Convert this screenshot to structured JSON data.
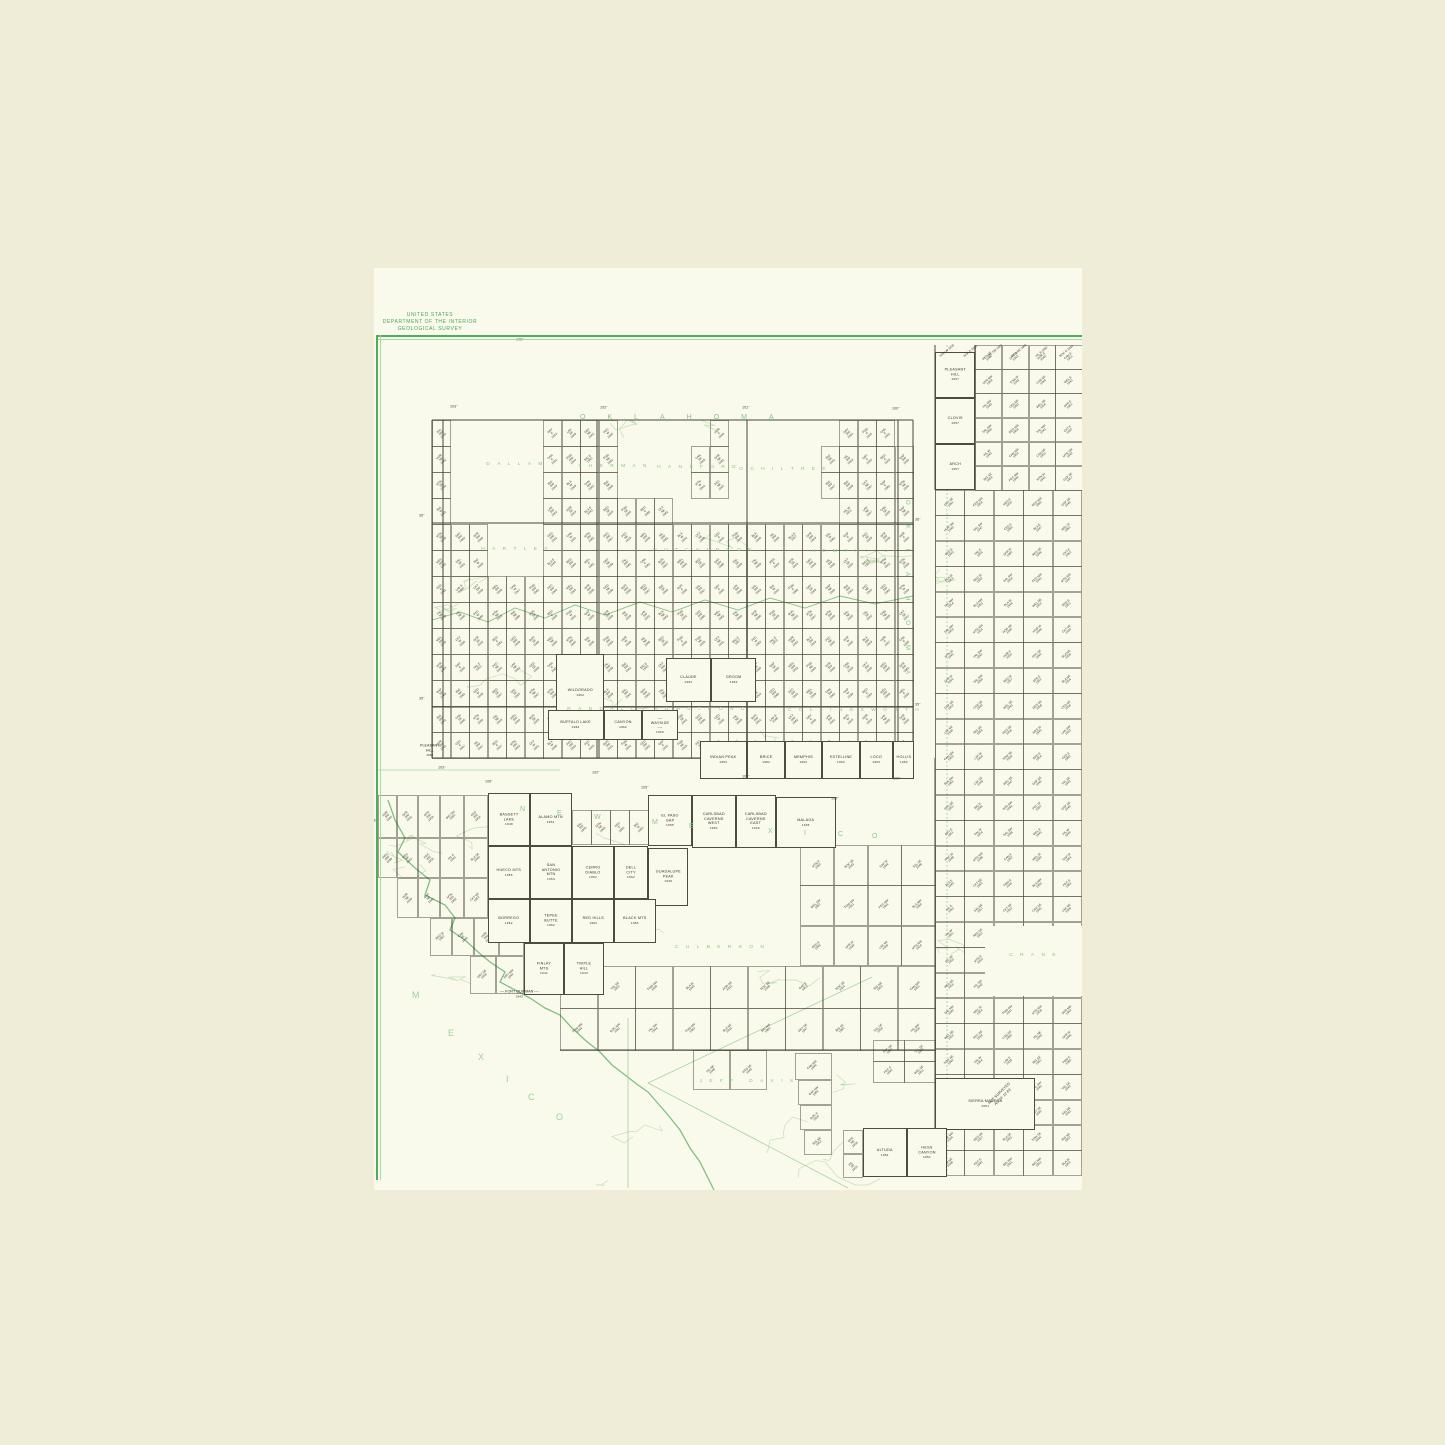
{
  "header": {
    "line1": "UNITED STATES",
    "line2": "DEPARTMENT OF THE INTERIOR",
    "line3": "GEOLOGICAL SURVEY"
  },
  "colors": {
    "outer_paper": "#efecd8",
    "page_paper": "#fafaec",
    "frame_green": "#4dad58",
    "county_green": "#84c583",
    "topo_green": "#bcdcb2",
    "river_green": "#7fbf83",
    "ink": "#3c3b30"
  },
  "state_labels": {
    "oklahoma_top": "OKLAHOMA",
    "oklahoma_vertical": "OKLAHOMA",
    "new_mexico_trail": [
      [
        "N",
        520,
        806
      ],
      [
        "E",
        557,
        810
      ],
      [
        "W",
        594,
        814
      ],
      [
        "M",
        652,
        819
      ],
      [
        "E",
        689,
        823
      ],
      [
        "X",
        768,
        828
      ],
      [
        "I",
        804,
        830
      ],
      [
        "C",
        838,
        831
      ],
      [
        "O",
        872,
        833
      ]
    ],
    "mexico_trail": [
      [
        "M",
        412,
        990
      ],
      [
        "E",
        448,
        1028
      ],
      [
        "X",
        478,
        1052
      ],
      [
        "I",
        506,
        1074
      ],
      [
        "C",
        528,
        1092
      ],
      [
        "O",
        556,
        1112
      ]
    ]
  },
  "county_labels": [
    {
      "t": "DALLAM",
      "x": 516,
      "y": 462
    },
    {
      "t": "SHERMAN",
      "x": 614,
      "y": 464
    },
    {
      "t": "HANSFORD",
      "x": 698,
      "y": 465
    },
    {
      "t": "OCHILTREE",
      "x": 784,
      "y": 467
    },
    {
      "t": "HARTLEY",
      "x": 516,
      "y": 547
    },
    {
      "t": "HUTCHINSON",
      "x": 704,
      "y": 548
    },
    {
      "t": "HEMPHILL",
      "x": 851,
      "y": 549
    },
    {
      "t": "RANDALL",
      "x": 602,
      "y": 707
    },
    {
      "t": "ARMSTRONG",
      "x": 701,
      "y": 707
    },
    {
      "t": "COLLINGSWORTH",
      "x": 855,
      "y": 708
    },
    {
      "t": "CULBERSON",
      "x": 721,
      "y": 945
    },
    {
      "t": "JEFF DAVIS",
      "x": 748,
      "y": 1079
    },
    {
      "t": "CRANE",
      "x": 1034,
      "y": 953
    }
  ],
  "coord_labels": [
    {
      "t": "106°",
      "x": 516,
      "y": 338
    },
    {
      "t": "103°",
      "x": 450,
      "y": 405
    },
    {
      "t": "102°",
      "x": 600,
      "y": 406
    },
    {
      "t": "101°",
      "x": 742,
      "y": 406
    },
    {
      "t": "100°",
      "x": 892,
      "y": 407
    },
    {
      "t": "103°",
      "x": 438,
      "y": 766
    },
    {
      "t": "102°",
      "x": 592,
      "y": 771
    },
    {
      "t": "101°",
      "x": 742,
      "y": 775
    },
    {
      "t": "100°",
      "x": 893,
      "y": 777
    },
    {
      "t": "106°",
      "x": 485,
      "y": 780
    },
    {
      "t": "105°",
      "x": 641,
      "y": 786
    },
    {
      "t": "104°",
      "x": 831,
      "y": 797
    },
    {
      "t": "36°",
      "x": 419,
      "y": 514
    },
    {
      "t": "36°",
      "x": 915,
      "y": 518
    },
    {
      "t": "35°",
      "x": 419,
      "y": 697
    },
    {
      "t": "35°",
      "x": 915,
      "y": 703
    },
    {
      "t": "32°",
      "x": 373,
      "y": 819
    }
  ],
  "big_cells": [
    {
      "n": "WILDORADO",
      "y2": "1962",
      "x": 556,
      "y": 654,
      "w": 48,
      "h": 78
    },
    {
      "n": "CLAUDE",
      "y2": "1962",
      "x": 666,
      "y": 658,
      "w": 45,
      "h": 44
    },
    {
      "n": "GROOM",
      "y2": "1962",
      "x": 711,
      "y": 658,
      "w": 45,
      "h": 44
    },
    {
      "n": "BUFFALO LAKE",
      "y2": "1962",
      "x": 548,
      "y": 710,
      "w": 56,
      "h": 30
    },
    {
      "n": "CANYON",
      "y2": "1962",
      "x": 604,
      "y": 710,
      "w": 38,
      "h": 30
    },
    {
      "n": "WAYSIDE",
      "y2": "1960",
      "x": 642,
      "y": 710,
      "w": 36,
      "h": 30,
      "leader": true
    },
    {
      "n": "INDIAN PEAK",
      "y2": "1954",
      "x": 700,
      "y": 741,
      "w": 47,
      "h": 38
    },
    {
      "n": "BRICE",
      "y2": "1962",
      "x": 747,
      "y": 741,
      "w": 38,
      "h": 38
    },
    {
      "n": "MEMPHIS",
      "y2": "1962",
      "x": 785,
      "y": 741,
      "w": 37,
      "h": 38
    },
    {
      "n": "ESTELLINE",
      "y2": "1962",
      "x": 822,
      "y": 741,
      "w": 38,
      "h": 38
    },
    {
      "n": "LOCO",
      "y2": "1960",
      "x": 860,
      "y": 741,
      "w": 33,
      "h": 38
    },
    {
      "n": "HOLLIS",
      "y2": "1962",
      "x": 893,
      "y": 741,
      "w": 21,
      "h": 38
    },
    {
      "n": "PLEASANT\nHILL",
      "y2": "1957",
      "x": 935,
      "y": 352,
      "w": 40,
      "h": 46
    },
    {
      "n": "CLOVIS",
      "y2": "1957",
      "x": 935,
      "y": 398,
      "w": 40,
      "h": 46
    },
    {
      "n": "ARCH",
      "y2": "1957",
      "x": 935,
      "y": 444,
      "w": 40,
      "h": 46
    },
    {
      "n": "BASSETT LAKE",
      "y2": "1948",
      "x": 488,
      "y": 793,
      "w": 42,
      "h": 53
    },
    {
      "n": "ALAMO MTN",
      "y2": "1954",
      "x": 530,
      "y": 793,
      "w": 42,
      "h": 53
    },
    {
      "n": "EL PASO GAP",
      "y2": "1955",
      "x": 648,
      "y": 795,
      "w": 44,
      "h": 51
    },
    {
      "n": "CARLSBAD\nCAVERNS\nWEST",
      "y2": "1954",
      "x": 692,
      "y": 795,
      "w": 44,
      "h": 53
    },
    {
      "n": "CARLSBAD\nCAVERNS\nEAST",
      "y2": "1948",
      "x": 736,
      "y": 795,
      "w": 40,
      "h": 53
    },
    {
      "n": "MALAGA",
      "y2": "1945",
      "x": 776,
      "y": 797,
      "w": 60,
      "h": 51
    },
    {
      "n": "HUECO MTS",
      "y2": "1955",
      "x": 488,
      "y": 846,
      "w": 42,
      "h": 53
    },
    {
      "n": "SAN ANTONIO\nMTN",
      "y2": "1954",
      "x": 530,
      "y": 846,
      "w": 42,
      "h": 53
    },
    {
      "n": "CERRO DIABLO",
      "y2": "1962",
      "x": 572,
      "y": 846,
      "w": 42,
      "h": 53
    },
    {
      "n": "DELL CITY",
      "y2": "1962",
      "x": 614,
      "y": 846,
      "w": 34,
      "h": 53
    },
    {
      "n": "GUADALUPE\nPEAK",
      "y2": "1939",
      "x": 648,
      "y": 848,
      "w": 40,
      "h": 58
    },
    {
      "n": "BORREGO",
      "y2": "1962",
      "x": 488,
      "y": 899,
      "w": 42,
      "h": 44
    },
    {
      "n": "TEPEE BUTTE",
      "y2": "1962",
      "x": 530,
      "y": 899,
      "w": 42,
      "h": 44
    },
    {
      "n": "RED HILLS",
      "y2": "1962",
      "x": 572,
      "y": 899,
      "w": 42,
      "h": 44
    },
    {
      "n": "BLACK MTS",
      "y2": "1954",
      "x": 614,
      "y": 899,
      "w": 42,
      "h": 44
    },
    {
      "n": "FINLAY MTS",
      "y2": "1941",
      "x": 524,
      "y": 943,
      "w": 40,
      "h": 52
    },
    {
      "n": "TRIPLE HILL",
      "y2": "1943",
      "x": 564,
      "y": 943,
      "w": 40,
      "h": 52
    },
    {
      "n": "SIERRA MADERA",
      "y2": "1951",
      "x": 935,
      "y": 1078,
      "w": 100,
      "h": 52
    },
    {
      "n": "ALTUDA",
      "y2": "1951",
      "x": 863,
      "y": 1128,
      "w": 44,
      "h": 49
    },
    {
      "n": "HESS CANYON",
      "y2": "1951",
      "x": 907,
      "y": 1128,
      "w": 40,
      "h": 49
    }
  ],
  "label_only": [
    {
      "n": "PLEASANT\nHILL",
      "y2": "1962",
      "x": 420,
      "y": 744,
      "leader": false
    },
    {
      "n": "FORT QUITMAN",
      "y2": "1943",
      "x": 500,
      "y": 990,
      "leader": true
    }
  ],
  "not_surveyed_note": "NOT SURVEYED\nAS OF 12-63",
  "grids": [
    {
      "x": 432,
      "y": 420,
      "cw": 18.5,
      "ch": 26,
      "cols": 26,
      "rows": 13,
      "mask": [
        "10000011110000010000001110",
        "10000011110000110000011111",
        "10000011110000110000011111",
        "10000011111110000000001111",
        "11100011111111111111111111",
        "11100011111111111111111111",
        "11111111111111111111111111",
        "11111111111111111111111111",
        "11111111111111111111111111",
        "11111111111111111111111111",
        "11111111111111111111111111",
        "11111111111111111111111111",
        "11111111111111111111111111"
      ]
    },
    {
      "x": 975,
      "y": 345,
      "cw": 26.75,
      "ch": 24.2,
      "cols": 4,
      "rows": 6,
      "mask": null
    },
    {
      "x": 935,
      "y": 490,
      "cw": 29.4,
      "ch": 25.4,
      "cols": 5,
      "rows": 27,
      "mask": null
    },
    {
      "x": 800,
      "y": 845,
      "cw": 33.75,
      "ch": 40.3,
      "cols": 4,
      "rows": 3,
      "mask": null
    },
    {
      "x": 560,
      "y": 966,
      "cw": 37.5,
      "ch": 42,
      "cols": 10,
      "rows": 2,
      "mask": null
    },
    {
      "x": 873,
      "y": 1040,
      "cw": 31,
      "ch": 21,
      "cols": 2,
      "rows": 2,
      "mask": null
    },
    {
      "x": 572,
      "y": 810,
      "cw": 19,
      "ch": 34,
      "cols": 4,
      "rows": 1,
      "mask": null
    }
  ],
  "loose_cells": [
    [
      378,
      795,
      19,
      43
    ],
    [
      397,
      795,
      21,
      43
    ],
    [
      418,
      795,
      22,
      43
    ],
    [
      440,
      795,
      24,
      43
    ],
    [
      464,
      795,
      24,
      43
    ],
    [
      378,
      838,
      19,
      40
    ],
    [
      397,
      838,
      21,
      40
    ],
    [
      418,
      838,
      22,
      40
    ],
    [
      440,
      838,
      24,
      40
    ],
    [
      464,
      838,
      24,
      40
    ],
    [
      397,
      878,
      21,
      40
    ],
    [
      418,
      878,
      22,
      40
    ],
    [
      440,
      878,
      24,
      40
    ],
    [
      464,
      878,
      24,
      40
    ],
    [
      430,
      918,
      22,
      38
    ],
    [
      452,
      918,
      22,
      38
    ],
    [
      474,
      918,
      25,
      38
    ],
    [
      499,
      918,
      25,
      38
    ],
    [
      470,
      956,
      26,
      38
    ],
    [
      496,
      956,
      28,
      38
    ],
    [
      693,
      1050,
      37,
      40
    ],
    [
      730,
      1050,
      37,
      40
    ],
    [
      795,
      1053,
      37,
      27
    ],
    [
      798,
      1080,
      34,
      25
    ],
    [
      800,
      1105,
      32,
      25
    ],
    [
      804,
      1130,
      28,
      25
    ],
    [
      843,
      1130,
      20,
      24
    ],
    [
      843,
      1154,
      20,
      24
    ]
  ],
  "patches": [
    {
      "x": 985,
      "y": 926,
      "w": 97,
      "h": 70
    },
    {
      "x": 914,
      "y": 490,
      "w": 21,
      "h": 268
    }
  ],
  "major_lines": [
    [
      443,
      420,
      443,
      758
    ],
    [
      597,
      420,
      597,
      758
    ],
    [
      747,
      420,
      747,
      758
    ],
    [
      898,
      420,
      898,
      758
    ],
    [
      432,
      523,
      913,
      523
    ],
    [
      432,
      707,
      913,
      707
    ],
    [
      935,
      345,
      935,
      1175
    ],
    [
      975,
      345,
      975,
      490
    ],
    [
      560,
      1050,
      935,
      1050
    ],
    [
      432,
      420,
      913,
      420
    ],
    [
      432,
      758,
      913,
      758
    ],
    [
      432,
      420,
      432,
      758
    ],
    [
      913,
      420,
      913,
      758
    ]
  ],
  "green_lines": [
    [
      628,
      1018,
      628,
      1188
    ],
    [
      648,
      1083,
      872,
      977
    ],
    [
      648,
      1083,
      848,
      1188
    ],
    [
      378,
      770,
      560,
      770
    ]
  ],
  "dotted_state_line": [
    947,
    345,
    947,
    1175
  ],
  "river_points": [
    [
      388,
      800
    ],
    [
      395,
      820
    ],
    [
      405,
      838
    ],
    [
      398,
      852
    ],
    [
      415,
      868
    ],
    [
      430,
      880
    ],
    [
      425,
      895
    ],
    [
      445,
      905
    ],
    [
      455,
      918
    ],
    [
      450,
      930
    ],
    [
      465,
      940
    ],
    [
      478,
      952
    ],
    [
      490,
      962
    ],
    [
      505,
      972
    ],
    [
      500,
      982
    ],
    [
      515,
      990
    ],
    [
      530,
      998
    ],
    [
      545,
      1008
    ],
    [
      560,
      1015
    ],
    [
      572,
      1028
    ],
    [
      585,
      1040
    ],
    [
      600,
      1052
    ],
    [
      612,
      1065
    ],
    [
      625,
      1075
    ],
    [
      638,
      1085
    ],
    [
      648,
      1092
    ],
    [
      655,
      1100
    ],
    [
      668,
      1115
    ],
    [
      680,
      1130
    ],
    [
      690,
      1148
    ],
    [
      700,
      1162
    ],
    [
      708,
      1178
    ],
    [
      714,
      1190
    ]
  ],
  "canadian_points": [
    [
      432,
      620
    ],
    [
      460,
      612
    ],
    [
      488,
      622
    ],
    [
      515,
      608
    ],
    [
      545,
      618
    ],
    [
      575,
      605
    ],
    [
      605,
      615
    ],
    [
      640,
      602
    ],
    [
      672,
      612
    ],
    [
      705,
      600
    ],
    [
      738,
      610
    ],
    [
      770,
      598
    ],
    [
      805,
      608
    ],
    [
      840,
      596
    ],
    [
      875,
      604
    ],
    [
      913,
      596
    ]
  ],
  "top_slant_labels": 6,
  "fillers": {
    "syllables": [
      "BLA",
      "CKT",
      "MES",
      "CED",
      "SPR",
      "WEL",
      "CAN",
      "HIL",
      "LAK",
      "MTN",
      "RED",
      "DRY",
      "BIG",
      "SAL",
      "PEC",
      "ROC",
      "VAL",
      "GAP",
      "HOR",
      "TOW"
    ],
    "suffixes": [
      "NW",
      "NE",
      "SW",
      "SE",
      "W",
      "E"
    ]
  }
}
